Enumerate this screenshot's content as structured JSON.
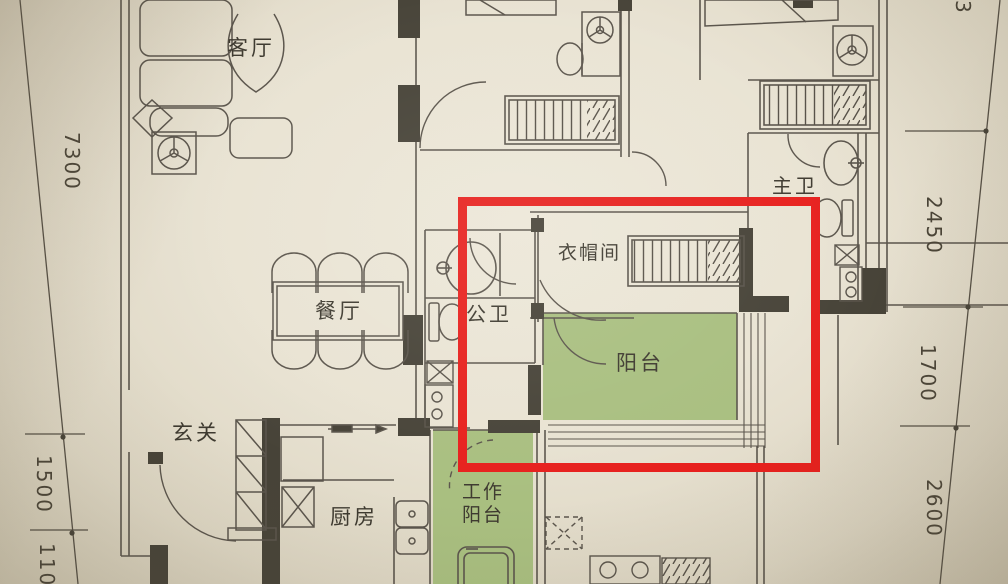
{
  "plan": {
    "type": "floor-plan-photo",
    "rooms": {
      "living": {
        "label": "客厅"
      },
      "dining": {
        "label": "餐厅"
      },
      "entry": {
        "label": "玄关"
      },
      "kitchen": {
        "label": "厨房"
      },
      "work_balcony": {
        "label": "工作\n阳台"
      },
      "public_bath": {
        "label": "公卫"
      },
      "cloakroom": {
        "label": "衣帽间"
      },
      "balcony": {
        "label": "阳台"
      },
      "master_bath": {
        "label": "主卫"
      }
    },
    "dimensions": {
      "left": [
        "7300",
        "1500",
        "1100"
      ],
      "right": [
        "3",
        "2450",
        "1700",
        "2600"
      ]
    },
    "highlight": {
      "shape": "rectangle",
      "color": "#e7201d"
    },
    "colors": {
      "paper": "#e9e3d3",
      "line": "#5b554c",
      "wall_fill": "#474338",
      "balcony_green": "#a9bf80",
      "text": "#3e3a30"
    }
  }
}
